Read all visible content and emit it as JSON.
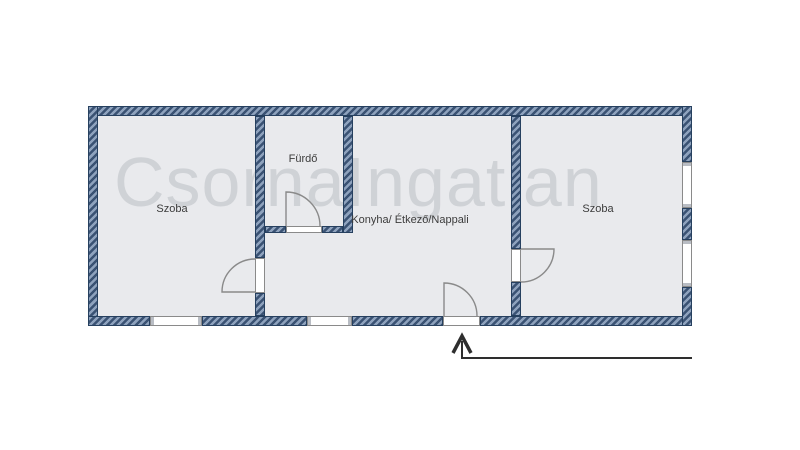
{
  "watermark": {
    "text": "CsornaIngatlan"
  },
  "floorplan": {
    "rooms": [
      {
        "id": "szoba-left",
        "label": "Szoba"
      },
      {
        "id": "furdo",
        "label": "Fürdő"
      },
      {
        "id": "konyha-etkezo-nappali",
        "label": "Konyha/ Étkező/Nappali"
      },
      {
        "id": "szoba-right",
        "label": "Szoba"
      }
    ],
    "symbols": {
      "door_count": 4,
      "window_count": 4,
      "entrance_arrow_direction": "up"
    },
    "colors": {
      "wall_stripe_light": "#8ea2bd",
      "wall_stripe_dark": "#3a5273",
      "wall_border": "#26405f",
      "room_fill": "#e9eaed",
      "door_line": "#8a8a8a",
      "arrow": "#2e2e2e",
      "watermark_gray": "#d9dbdf",
      "background": "#ffffff"
    }
  }
}
